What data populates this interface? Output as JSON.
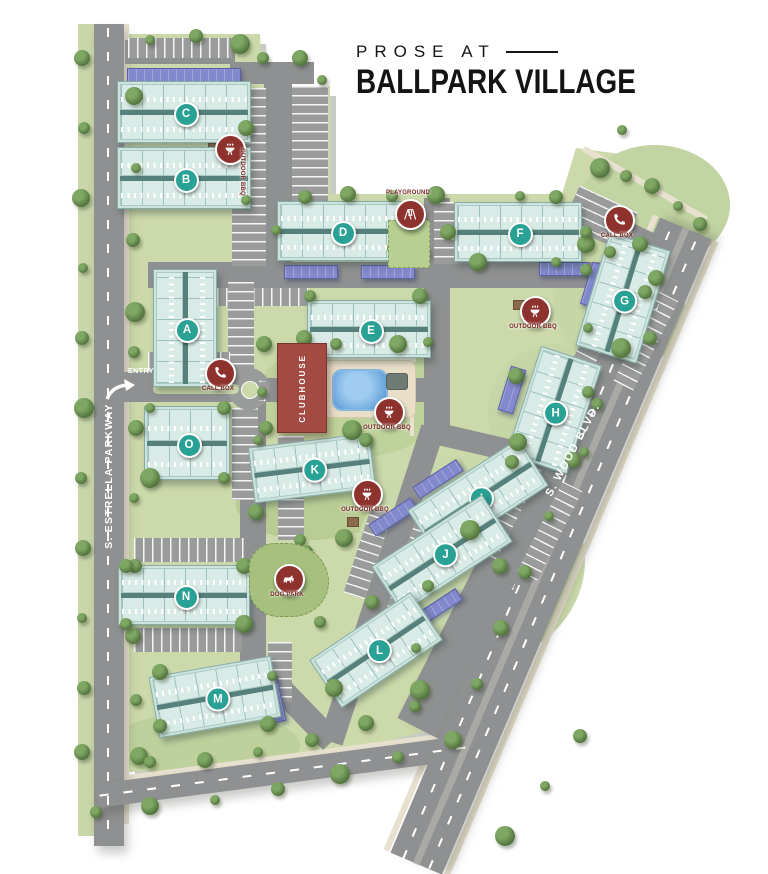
{
  "title": {
    "pre": "PROSE AT",
    "main": "BALLPARK VILLAGE"
  },
  "road_labels": {
    "left": "S. ESTRELLA PARKWAY",
    "right": "S. WOOD BLVD.",
    "entry": "ENTRY"
  },
  "clubhouse_label": "CLUBHOUSE",
  "colors": {
    "site_green": "#ccd9ab",
    "road_gray": "#8f9091",
    "building_teal": "#cfe3de",
    "badge_teal": "#2aa195",
    "clubhouse_red": "#a34b43",
    "amenity_red": "#8e322d",
    "carport_purple": "#8289cc",
    "pool_blue": "#4b90d2",
    "label_red": "#76261f",
    "tree_green": "#55763f",
    "sidewalk_tan": "#e9e1cf",
    "title_black": "#141414"
  },
  "buildings": [
    {
      "id": "C",
      "x": 183,
      "y": 111,
      "w": 132,
      "h": 60,
      "rot": 0,
      "v": false
    },
    {
      "id": "B",
      "x": 183,
      "y": 177,
      "w": 132,
      "h": 60,
      "rot": 0,
      "v": false
    },
    {
      "id": "A",
      "x": 184,
      "y": 327,
      "w": 62,
      "h": 116,
      "rot": 0,
      "v": true
    },
    {
      "id": "O",
      "x": 186,
      "y": 442,
      "w": 84,
      "h": 72,
      "rot": 0,
      "v": false
    },
    {
      "id": "N",
      "x": 183,
      "y": 594,
      "w": 130,
      "h": 58,
      "rot": 0,
      "v": false
    },
    {
      "id": "M",
      "x": 214,
      "y": 696,
      "w": 122,
      "h": 60,
      "rot": -10,
      "v": false
    },
    {
      "id": "D",
      "x": 340,
      "y": 230,
      "w": 126,
      "h": 58,
      "rot": 0,
      "v": false
    },
    {
      "id": "E",
      "x": 368,
      "y": 328,
      "w": 122,
      "h": 56,
      "rot": 0,
      "v": false
    },
    {
      "id": "F",
      "x": 517,
      "y": 231,
      "w": 126,
      "h": 58,
      "rot": 0,
      "v": false
    },
    {
      "id": "G",
      "x": 622,
      "y": 297,
      "w": 62,
      "h": 116,
      "rot": 17,
      "v": true
    },
    {
      "id": "H",
      "x": 553,
      "y": 409,
      "w": 62,
      "h": 112,
      "rot": 18,
      "v": true
    },
    {
      "id": "I",
      "x": 477,
      "y": 497,
      "w": 130,
      "h": 54,
      "rot": -33,
      "v": false
    },
    {
      "id": "J",
      "x": 441,
      "y": 553,
      "w": 130,
      "h": 54,
      "rot": -33,
      "v": false
    },
    {
      "id": "K",
      "x": 311,
      "y": 467,
      "w": 120,
      "h": 54,
      "rot": -7,
      "v": false
    },
    {
      "id": "L",
      "x": 375,
      "y": 649,
      "w": 120,
      "h": 56,
      "rot": -34,
      "v": false
    }
  ],
  "amenities": [
    {
      "icon": "bbq-icon",
      "label": "OUTDOOR BBQ",
      "x": 228,
      "y": 147,
      "lp": "rot"
    },
    {
      "icon": "phone-icon",
      "label": "CALL BOX",
      "x": 218,
      "y": 371,
      "lp": "below"
    },
    {
      "icon": "phone-icon",
      "label": "CALL BOX",
      "x": 617,
      "y": 218,
      "lp": "below"
    },
    {
      "icon": "playground-icon",
      "label": "PLAYGROUND",
      "x": 408,
      "y": 212,
      "lp": "above"
    },
    {
      "icon": "bbq-icon",
      "label": "OUTDOOR BBQ",
      "x": 387,
      "y": 410,
      "lp": "below"
    },
    {
      "icon": "bbq-icon",
      "label": "OUTDOOR BBQ",
      "x": 533,
      "y": 309,
      "lp": "below"
    },
    {
      "icon": "bbq-icon",
      "label": "OUTDOOR BBQ",
      "x": 365,
      "y": 492,
      "lp": "below"
    },
    {
      "icon": "dog-icon",
      "label": "DOG PARK",
      "x": 287,
      "y": 577,
      "lp": "below"
    }
  ],
  "map": {
    "roads_major": [
      {
        "name": "estrella-parkway-road",
        "r": [
          109,
          435,
          30,
          822,
          0
        ]
      },
      {
        "name": "wood-blvd-road",
        "r": [
          545,
          490,
          540,
          56,
          -63
        ]
      },
      {
        "name": "bottom-road",
        "r": [
          287,
          771,
          384,
          24,
          -7.5
        ]
      }
    ],
    "wood_full": [
      551,
      546,
      690,
      56,
      -67
    ],
    "roads": [
      [
        187,
        387,
        134,
        30,
        0
      ],
      [
        342,
        390,
        190,
        24,
        0
      ],
      [
        272,
        73,
        84,
        22,
        0
      ],
      [
        278,
        180,
        28,
        212,
        0
      ],
      [
        400,
        275,
        504,
        26,
        0
      ],
      [
        437,
        315,
        26,
        234,
        0
      ],
      [
        382,
        585,
        330,
        24,
        -72
      ],
      [
        253,
        533,
        26,
        274,
        0
      ],
      [
        292,
        701,
        113,
        24,
        46
      ],
      [
        545,
        490,
        540,
        24,
        -63
      ],
      [
        495,
        447,
        140,
        22,
        13
      ],
      [
        628,
        232,
        72,
        20,
        25
      ],
      [
        180,
        52,
        110,
        24,
        0
      ]
    ],
    "sidewalks": [
      [
        126,
        424,
        5,
        800,
        0
      ],
      [
        521,
        533,
        690,
        6,
        -67
      ],
      [
        581,
        559,
        690,
        6,
        -67
      ],
      [
        287,
        756,
        380,
        5,
        -7.5
      ],
      [
        645,
        184,
        142,
        6,
        30
      ],
      [
        368,
        360,
        96,
        4,
        0
      ],
      [
        412,
        418,
        4,
        36,
        0
      ],
      [
        277,
        388,
        30,
        4,
        0
      ]
    ],
    "green_strips": [
      [
        86,
        430,
        16,
        812,
        0
      ]
    ],
    "dashes": [
      [
        108,
        433,
        2,
        810,
        0
      ],
      [
        287,
        771,
        378,
        2,
        -7.5
      ],
      [
        564,
        551,
        690,
        2,
        -67
      ],
      [
        538,
        541,
        690,
        2,
        -67
      ]
    ],
    "median_band": [
      551,
      546,
      690,
      7,
      -67
    ],
    "entry_median": [
      196,
      389,
      86,
      10
    ],
    "roundabout": [
      249,
      389,
      42,
      16
    ],
    "lots": [
      {
        "r": [
          249,
          177,
          34,
          178,
          0
        ],
        "d": "h"
      },
      {
        "r": [
          310,
          151,
          36,
          130,
          0
        ],
        "d": "h"
      },
      {
        "r": [
          453,
          233,
          38,
          62,
          0
        ],
        "d": "h"
      },
      {
        "r": [
          258,
          297,
          100,
          18,
          0
        ],
        "d": "v"
      },
      {
        "r": [
          241,
          328,
          26,
          92,
          0
        ],
        "d": "h"
      },
      {
        "r": [
          245,
          454,
          26,
          92,
          0
        ],
        "d": "h"
      },
      {
        "r": [
          291,
          488,
          26,
          104,
          0
        ],
        "d": "h"
      },
      {
        "r": [
          189,
          550,
          110,
          24,
          0
        ],
        "d": "v"
      },
      {
        "r": [
          188,
          640,
          108,
          24,
          0
        ],
        "d": "v"
      },
      {
        "r": [
          189,
          362,
          82,
          20,
          0
        ],
        "d": "v"
      },
      {
        "r": [
          189,
          416,
          82,
          20,
          0
        ],
        "d": "v"
      },
      {
        "r": [
          605,
          320,
          100,
          22,
          -63
        ],
        "d": "v"
      },
      {
        "r": [
          646,
          341,
          100,
          22,
          -63
        ],
        "d": "v"
      },
      {
        "r": [
          509,
          510,
          100,
          22,
          -63
        ],
        "d": "v"
      },
      {
        "r": [
          550,
          531,
          100,
          22,
          -63
        ],
        "d": "v"
      },
      {
        "r": [
          600,
          218,
          64,
          42,
          25
        ],
        "d": "h"
      },
      {
        "r": [
          368,
          553,
          90,
          22,
          -72
        ],
        "d": "v"
      },
      {
        "r": [
          412,
          567,
          90,
          22,
          -72
        ],
        "d": "v"
      },
      {
        "r": [
          280,
          672,
          24,
          60,
          0
        ],
        "d": "h"
      },
      {
        "r": [
          180,
          48,
          104,
          20,
          0
        ],
        "d": "v"
      }
    ],
    "carports": [
      [
        183,
        74,
        112,
        13,
        0
      ],
      [
        310,
        271,
        52,
        12,
        0
      ],
      [
        387,
        271,
        52,
        12,
        0
      ],
      [
        563,
        268,
        48,
        12,
        0
      ],
      [
        593,
        284,
        14,
        42,
        17
      ],
      [
        511,
        389,
        14,
        44,
        17
      ],
      [
        437,
        478,
        50,
        12,
        -33
      ],
      [
        392,
        516,
        48,
        12,
        -33
      ],
      [
        438,
        606,
        46,
        12,
        -33
      ],
      [
        271,
        699,
        17,
        44,
        -12
      ]
    ],
    "patches": [
      [
        352,
        398,
        190,
        120,
        "#c0d29b"
      ],
      [
        311,
        505,
        150,
        70,
        "#b9cc94"
      ],
      [
        620,
        300,
        130,
        150,
        "#c6d6a6"
      ],
      [
        553,
        414,
        130,
        140,
        "#c6d6a6"
      ],
      [
        470,
        560,
        230,
        210,
        "#cad9ab"
      ],
      [
        205,
        745,
        190,
        66,
        "#bed09c"
      ],
      [
        655,
        205,
        150,
        120,
        "#c3d4a3"
      ]
    ],
    "dogpark": [
      288,
      579,
      78,
      72
    ],
    "playground": {
      "rect": [
        408,
        243,
        40,
        46
      ],
      "dots": [
        [
          400,
          252,
          "#4f86c6"
        ],
        [
          412,
          258,
          "#c65a4f"
        ],
        [
          404,
          263,
          "#e0b13f"
        ]
      ]
    },
    "pool_deck": [
      366,
      388,
      96,
      56
    ],
    "pool": [
      358,
      388,
      52,
      38
    ],
    "ramada": [
      396,
      380,
      20,
      15
    ],
    "tables": [
      [
        213,
        147
      ],
      [
        518,
        304
      ],
      [
        352,
        521
      ]
    ],
    "arrows": {
      "entry": [
        {
          "t": "←",
          "x": 263,
          "y": 381
        },
        {
          "t": "→",
          "x": 263,
          "y": 400
        }
      ],
      "wood": [
        {
          "x": 660,
          "y": 308,
          "rot": 203
        },
        {
          "x": 516,
          "y": 588,
          "rot": 203
        }
      ]
    },
    "trees": [
      [
        82,
        58
      ],
      [
        84,
        128
      ],
      [
        81,
        198
      ],
      [
        83,
        268
      ],
      [
        82,
        338
      ],
      [
        84,
        408
      ],
      [
        81,
        478
      ],
      [
        83,
        548
      ],
      [
        82,
        618
      ],
      [
        84,
        688
      ],
      [
        82,
        752
      ],
      [
        96,
        812
      ],
      [
        134,
        96
      ],
      [
        136,
        168
      ],
      [
        133,
        240
      ],
      [
        135,
        312
      ],
      [
        134,
        352
      ],
      [
        136,
        428
      ],
      [
        134,
        498
      ],
      [
        135,
        566
      ],
      [
        133,
        636
      ],
      [
        136,
        700
      ],
      [
        139,
        756
      ],
      [
        150,
        40
      ],
      [
        196,
        36
      ],
      [
        240,
        44
      ],
      [
        263,
        58
      ],
      [
        300,
        58
      ],
      [
        322,
        80
      ],
      [
        305,
        197
      ],
      [
        348,
        194
      ],
      [
        392,
        196
      ],
      [
        436,
        195
      ],
      [
        520,
        196
      ],
      [
        556,
        197
      ],
      [
        600,
        168
      ],
      [
        626,
        176
      ],
      [
        652,
        186
      ],
      [
        678,
        206
      ],
      [
        700,
        224
      ],
      [
        640,
        244
      ],
      [
        610,
        252
      ],
      [
        586,
        244
      ],
      [
        622,
        130
      ],
      [
        645,
        292
      ],
      [
        621,
        348
      ],
      [
        597,
        404
      ],
      [
        573,
        460
      ],
      [
        549,
        516
      ],
      [
        525,
        572
      ],
      [
        501,
        628
      ],
      [
        477,
        684
      ],
      [
        453,
        740
      ],
      [
        545,
        786
      ],
      [
        580,
        736
      ],
      [
        505,
        836
      ],
      [
        150,
        762
      ],
      [
        205,
        760
      ],
      [
        258,
        752
      ],
      [
        312,
        740
      ],
      [
        366,
        723
      ],
      [
        415,
        706
      ],
      [
        150,
        806
      ],
      [
        215,
        800
      ],
      [
        278,
        789
      ],
      [
        340,
        774
      ],
      [
        398,
        757
      ],
      [
        264,
        344
      ],
      [
        262,
        392
      ],
      [
        266,
        428
      ],
      [
        304,
        338
      ],
      [
        336,
        344
      ],
      [
        398,
        344
      ],
      [
        428,
        342
      ],
      [
        316,
        408
      ],
      [
        352,
        430
      ],
      [
        310,
        296
      ],
      [
        420,
        296
      ],
      [
        276,
        230
      ],
      [
        406,
        230
      ],
      [
        448,
        232
      ],
      [
        586,
        232
      ],
      [
        478,
        262
      ],
      [
        556,
        262
      ],
      [
        394,
        248
      ],
      [
        420,
        253
      ],
      [
        586,
        270
      ],
      [
        656,
        278
      ],
      [
        588,
        328
      ],
      [
        650,
        338
      ],
      [
        516,
        376
      ],
      [
        588,
        392
      ],
      [
        518,
        442
      ],
      [
        584,
        452
      ],
      [
        512,
        462
      ],
      [
        470,
        530
      ],
      [
        428,
        586
      ],
      [
        500,
        566
      ],
      [
        258,
        440
      ],
      [
        366,
        440
      ],
      [
        256,
        512
      ],
      [
        300,
        540
      ],
      [
        344,
        538
      ],
      [
        150,
        408
      ],
      [
        224,
        408
      ],
      [
        150,
        478
      ],
      [
        224,
        478
      ],
      [
        246,
        128
      ],
      [
        246,
        200
      ],
      [
        126,
        566
      ],
      [
        244,
        566
      ],
      [
        126,
        624
      ],
      [
        244,
        624
      ],
      [
        262,
        556
      ],
      [
        306,
        552
      ],
      [
        268,
        600
      ],
      [
        300,
        602
      ],
      [
        160,
        672
      ],
      [
        272,
        676
      ],
      [
        160,
        726
      ],
      [
        268,
        724
      ],
      [
        320,
        622
      ],
      [
        334,
        688
      ],
      [
        416,
        648
      ],
      [
        372,
        602
      ],
      [
        420,
        690
      ]
    ]
  }
}
